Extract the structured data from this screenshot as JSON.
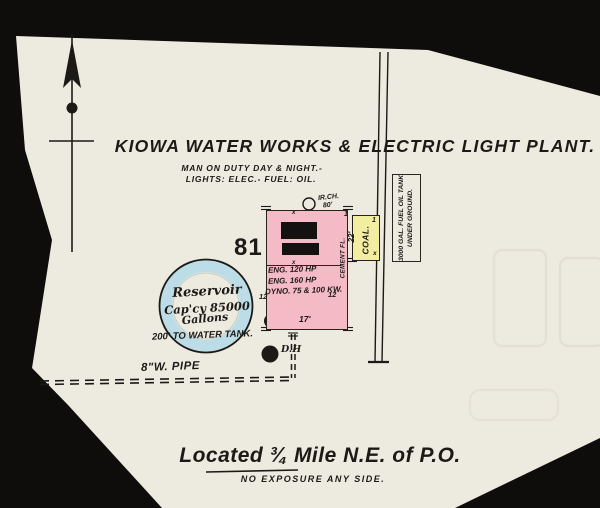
{
  "colors": {
    "background": "#0e0d0b",
    "paper": "#edeae0",
    "ink": "#1c1a16",
    "building": "#f4bbc7",
    "coal": "#f2eda0",
    "water": "#bcdde7",
    "ghost": "#e2dfd2"
  },
  "header": {
    "title": "KIOWA WATER WORKS & ELECTRIC LIGHT PLANT.",
    "subtitle1": "MAN ON DUTY DAY & NIGHT.-",
    "subtitle2": "LIGHTS: ELEC.- FUEL: OIL."
  },
  "block_number": "81",
  "plant": {
    "engine1": "ENG. 120 HP",
    "engine2": "ENG. 160 HP",
    "dynamo": "DYNO. 75 & 100 KW.",
    "height_left": "12",
    "height_right": "12",
    "front_width": "17'",
    "depth": "22'",
    "floor": "CEMENT FL.",
    "chimney_type": "IR.CH.",
    "chimney_height": "80'",
    "stories": "1",
    "opening_mark": "x"
  },
  "coal_shed": {
    "label": "COAL.",
    "stories": "1",
    "mark": "x"
  },
  "fuel_tank": {
    "line1": "3000 GAL. FUEL OIL TANK",
    "line2": "UNDER GROUND."
  },
  "reservoir": {
    "name": "Reservoir",
    "capacity": "Cap'cy 85000",
    "unit": "Gallons",
    "note": "200' TO WATER TANK."
  },
  "well_label": "D.H",
  "pipe_label": "8\"W. PIPE",
  "footer": {
    "location": "Located ¾ Mile N.E. of P.O.",
    "exposure": "NO EXPOSURE ANY SIDE."
  },
  "icons": {
    "north_arrow": "arrow-up",
    "chimney": "circle-outline",
    "well": "double-circle",
    "drill_hole": "filled-dot",
    "water_pipe": "double-dashed-line"
  }
}
